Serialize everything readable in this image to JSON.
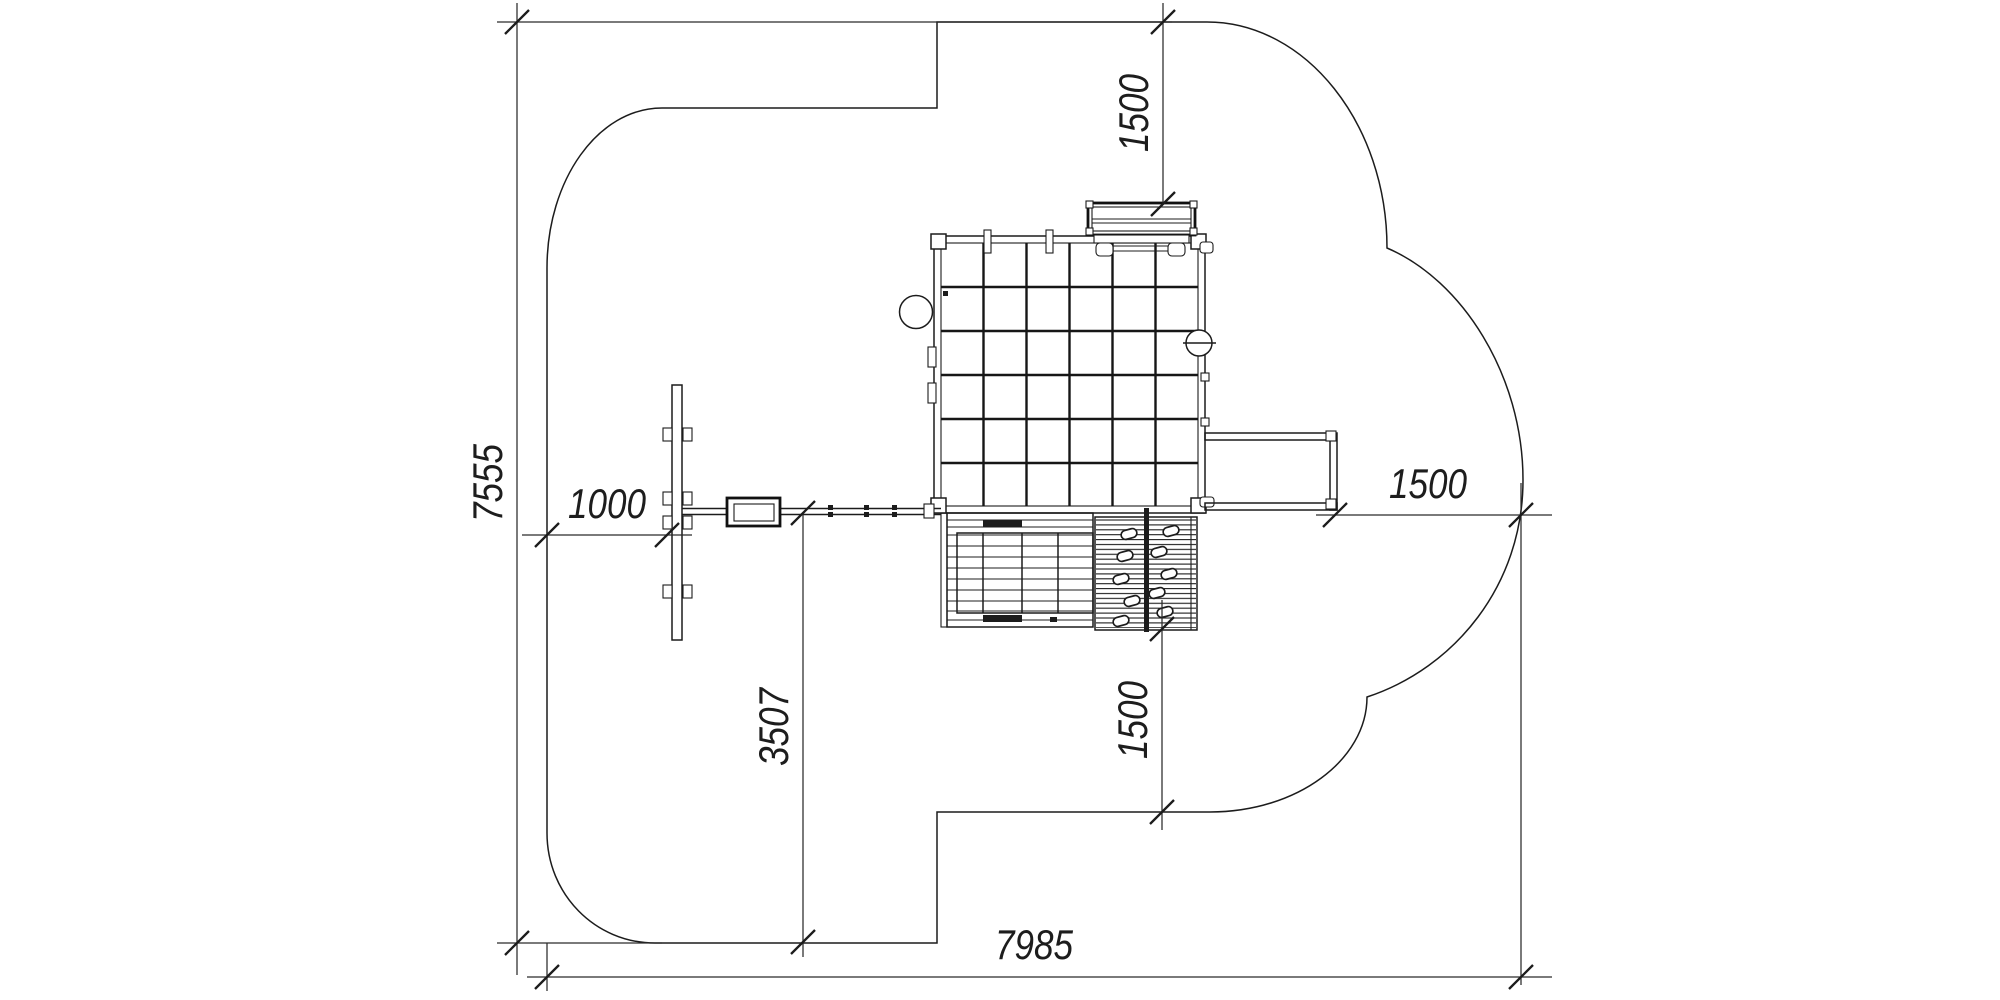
{
  "drawing": {
    "background": "#ffffff",
    "line_color": "#1c1c1c",
    "kind": "playground equipment plan view with safety zone"
  },
  "dims": {
    "top": "1500",
    "left": "7555",
    "beam": "1000",
    "center": "3507",
    "right": "1500",
    "bottom_mid": "1500",
    "total": "7985"
  }
}
